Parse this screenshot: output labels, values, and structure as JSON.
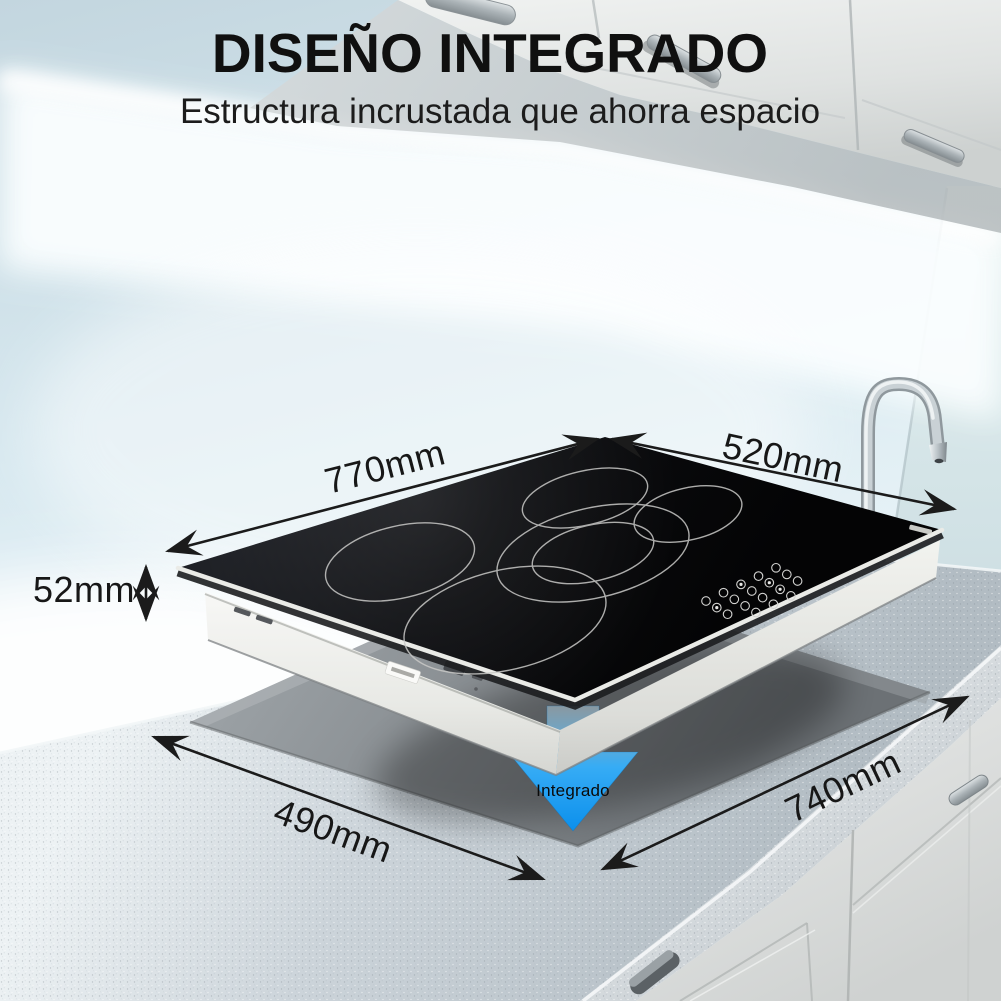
{
  "header": {
    "title": "DISEÑO INTEGRADO",
    "subtitle": "Estructura incrustada que ahorra espacio"
  },
  "annotations": {
    "cooktop_width": "770mm",
    "cooktop_depth": "520mm",
    "cooktop_height": "52mm",
    "cutout_width": "490mm",
    "cutout_depth": "740mm",
    "embed_label": "Integrado"
  },
  "scene": {
    "product": "cooktop de 5 zonas empotrado en encimera",
    "burner_count": 5
  },
  "colors": {
    "title_text": "#101010",
    "label_text": "#171717",
    "embed_arrow_blue": "#17a0f6",
    "cooktop_glass": "#0a0b0d",
    "steel_trim": "#ededeb",
    "counter_gray": "#c9d2d8",
    "cutout_gray": "#84888c",
    "wall_blue": "#d3e7ef"
  }
}
